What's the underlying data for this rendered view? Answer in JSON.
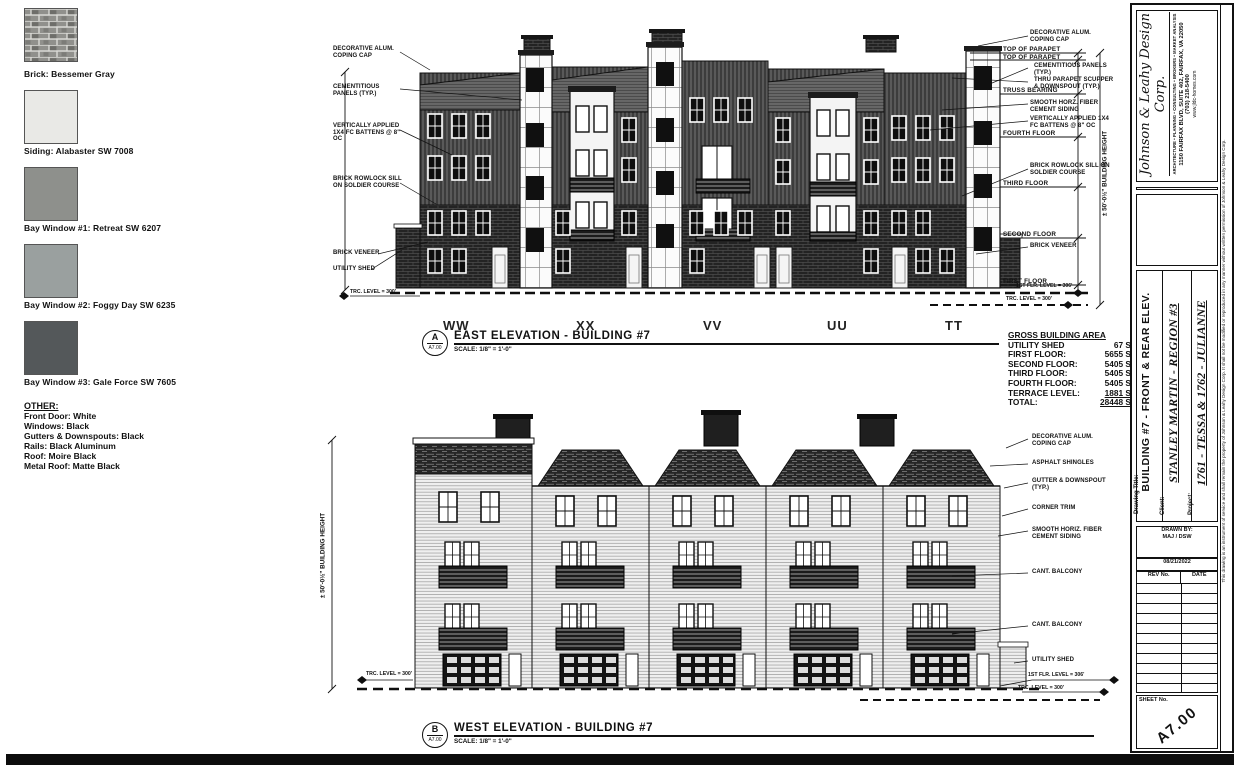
{
  "legend": {
    "swatches": [
      {
        "label": "Brick: Bessemer Gray",
        "color": "#94948f"
      },
      {
        "label": "Siding: Alabaster SW 7008",
        "color": "#e9e9e6"
      },
      {
        "label": "Bay Window #1: Retreat SW 6207",
        "color": "#8e908c"
      },
      {
        "label": "Bay Window #2: Foggy Day SW 6235",
        "color": "#9aa09f"
      },
      {
        "label": "Bay Window #3: Gale Force SW 7605",
        "color": "#54585a"
      }
    ],
    "other": {
      "heading": "OTHER:",
      "items": [
        "Front Door: White",
        "Windows: Black",
        "Gutters & Downspouts: Black",
        "Rails: Black Aluminum",
        "Roof: Moire Black",
        "Metal Roof: Matte Black"
      ]
    }
  },
  "east": {
    "detail_letter": "A",
    "detail_sheet": "A7.00",
    "title": "EAST ELEVATION - BUILDING #7",
    "scale": "SCALE: 1/8\" = 1'-0\"",
    "units": [
      "WW",
      "XX",
      "VV",
      "UU",
      "TT"
    ],
    "left_callouts": [
      "DECORATIVE ALUM. COPING CAP",
      "CEMENTITIOUS PANELS (TYP.)",
      "VERTICALLY APPLIED 1X4 FC BATTENS @ 8\" OC",
      "BRICK ROWLOCK SILL ON SOLDIER COURSE",
      "BRICK VENEER",
      "UTILITY SHED"
    ],
    "right_callouts": [
      "DECORATIVE ALUM. COPING CAP",
      "CEMENTITIOUS PANELS (TYP.)",
      "THRU PARAPET SCUPPER & DOWNSPOUT (TYP.)",
      "SMOOTH HORZ. FIBER CEMENT SIDING",
      "VERTICALLY APPLIED 1X4 FC BATTENS @ 8\" OC",
      "BRICK ROWLOCK SILL ON SOLDIER COURSE",
      "BRICK VENEER"
    ],
    "floor_labels": [
      "TOP OF PARAPET",
      "TOP OF PARAPET",
      "TRUSS BEARING",
      "FOURTH FLOOR",
      "THIRD FLOOR",
      "SECOND FLOOR",
      "FIRST FLOOR"
    ],
    "height_dim": "± 50'-0½\" BUILDING HEIGHT",
    "datum_left": "TRC. LEVEL = 300'",
    "datum_r1": "1ST FLR. LEVEL = 306'",
    "datum_r2": "TRC. LEVEL = 300'"
  },
  "area_table": {
    "title": "GROSS BUILDING AREA",
    "rows": [
      [
        "UTILITY SHED",
        "67 SF"
      ],
      [
        "FIRST FLOOR:",
        "5655 SF"
      ],
      [
        "SECOND FLOOR:",
        "5405 SF"
      ],
      [
        "THIRD FLOOR:",
        "5405 SF"
      ],
      [
        "FOURTH FLOOR:",
        "5405 SF"
      ],
      [
        "TERRACE LEVEL:",
        "1881 SF"
      ],
      [
        "TOTAL:",
        "28448 SF"
      ]
    ]
  },
  "west": {
    "detail_letter": "B",
    "detail_sheet": "A7.00",
    "title": "WEST ELEVATION - BUILDING #7",
    "scale": "SCALE: 1/8\" = 1'-0\"",
    "right_callouts": [
      "DECORATIVE ALUM. COPING CAP",
      "ASPHALT SHINGLES",
      "GUTTER & DOWNSPOUT (TYP.)",
      "CORNER TRIM",
      "SMOOTH HORIZ. FIBER CEMENT SIDING",
      "CANT. BALCONY",
      "CANT. BALCONY",
      "UTILITY SHED"
    ],
    "height_dim": "± 50'-0½\" BUILDING HEIGHT",
    "datum_left": "TRC. LEVEL = 300'",
    "datum_r1": "1ST FLR. LEVEL = 306'",
    "datum_r2": "TRC. LEVEL = 300'"
  },
  "titleblock": {
    "firm": "Johnson & Leahy Design Corp.",
    "tagline": "ARCHITECTURE • PLANNING • CONSULTING • BROKERS • MARKET ANALYSIS",
    "address": "1150 FAIRFAX BLVD, SUITE 402, FAIRFAX, VA 22050",
    "phone": "(703) 218-5400",
    "website": "www.jldc-homes.com",
    "drawing_title_label": "Drawing Title:",
    "drawing_title": "BUILDING #7 - FRONT & REAR ELEV.",
    "client_label": "Client:",
    "client": "STANLEY MARTIN - REGION #3",
    "project_label": "Project:",
    "project": "1761 - TESSA & 1762 - JULIANNE",
    "drawn_by_label": "DRAWN BY:",
    "drawn_by": "MAJ / DSW",
    "date": "08/21/2022",
    "rev_col": "REV No.",
    "date_col": "DATE",
    "sheet_label": "SHEET No.",
    "sheet_number": "A7.00",
    "disclaimer": "This drawing is an instrument of service and shall remain the property of Johnson & Leahy Design Corp. It shall not be modified or reproduced in any manner without written permission of Johnson & Leahy Design Corp."
  }
}
